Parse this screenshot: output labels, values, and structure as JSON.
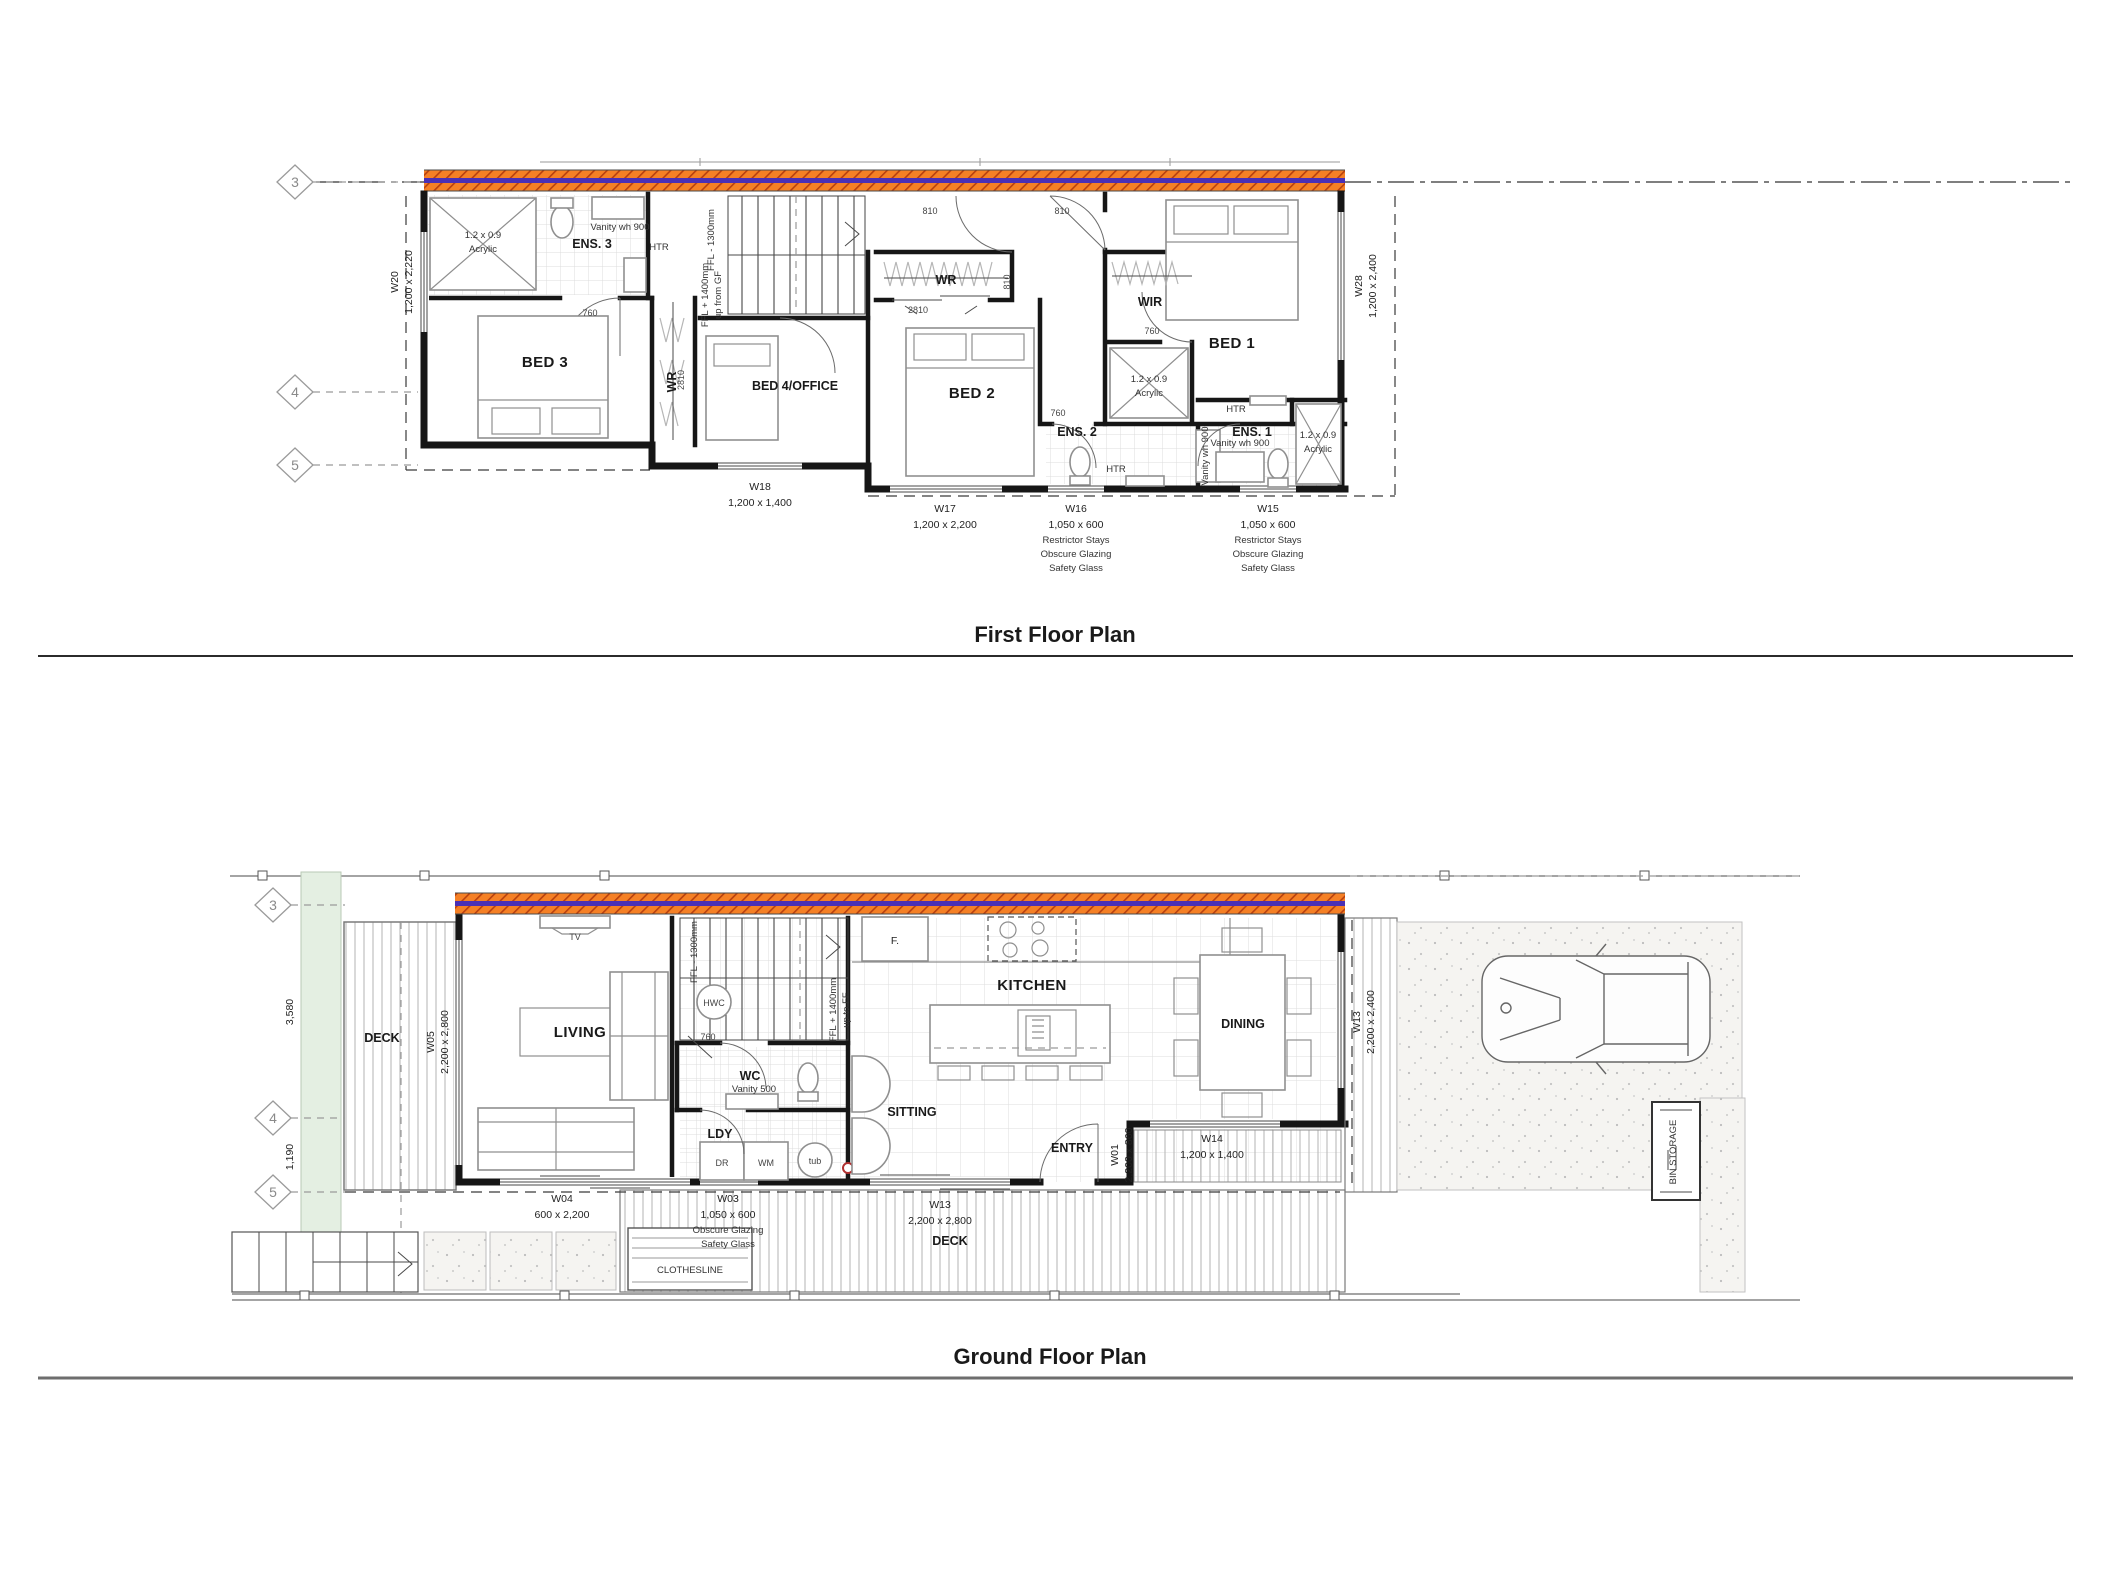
{
  "page": {
    "ff_title": "First Floor Plan",
    "gf_title": "Ground Floor Plan"
  },
  "colors": {
    "party_wall": "#f58025",
    "party_stripe": "#4a30b5"
  },
  "ff": {
    "rooms": {
      "ens3": "ENS. 3",
      "bed3": "BED 3",
      "bed4": "BED 4/OFFICE",
      "bed2": "BED 2",
      "bed1": "BED 1",
      "wir": "WIR",
      "wr": "WR",
      "ens2": "ENS. 2",
      "ens1": "ENS. 1"
    },
    "fix": {
      "shower_size": "1.2 x 0.9",
      "shower_mat": "Acrylic",
      "vanity": "Vanity wh 900",
      "htr": "HTR"
    },
    "stair": {
      "down": "FFL - 1300mm",
      "up1": "FFL + 1400mm",
      "up2": "up from GF"
    },
    "door": {
      "d760": "760",
      "d810": "810",
      "d2810": "2810"
    },
    "win": {
      "w20": [
        "W20",
        "1,200 x 2,220"
      ],
      "w28": [
        "W28",
        "1,200 x 2,400"
      ],
      "w18": [
        "W18",
        "1,200 x 1,400"
      ],
      "w17": [
        "W17",
        "1,200 x 2,200"
      ],
      "w16": [
        "W16",
        "1,050 x 600"
      ],
      "w15": [
        "W15",
        "1,050 x 600"
      ],
      "notes": [
        "Restrictor Stays",
        "Obscure Glazing",
        "Safety Glass"
      ]
    },
    "grid": [
      "3",
      "4",
      "5"
    ]
  },
  "gf": {
    "rooms": {
      "deck": "DECK",
      "living": "LIVING",
      "wc": "WC",
      "ldy": "LDY",
      "sitting": "SITTING",
      "kitchen": "KITCHEN",
      "dining": "DINING",
      "entry": "ENTRY",
      "clothesline": "CLOTHESLINE",
      "bin": "BIN STORAGE"
    },
    "fix": {
      "tv": "TV",
      "fridge": "F.",
      "dr": "DR",
      "wm": "WM",
      "tub": "tub",
      "vanity": "Vanity 500",
      "hwc": "HWC"
    },
    "stair": {
      "down": "FFL - 1300mm",
      "up1": "FFL + 1400mm",
      "up2": "up to FF"
    },
    "door": {
      "d760": "760"
    },
    "dim": {
      "a": "3,580",
      "b": "1,190"
    },
    "win": {
      "w05": [
        "W05",
        "2,200 x 2,800"
      ],
      "w04": [
        "W04",
        "600 x 2,200"
      ],
      "w03": [
        "W03",
        "1,050 x 600"
      ],
      "w03n": [
        "Obscure Glazing",
        "Safety Glass"
      ],
      "w13s": [
        "W13",
        "2,200 x 2,800"
      ],
      "w13e": [
        "W13",
        "2,200 x 2,400"
      ],
      "w14": [
        "W14",
        "1,200 x 1,400"
      ],
      "w01": [
        "W01",
        "2,200 x 860"
      ]
    },
    "grid": [
      "3",
      "4",
      "5"
    ]
  }
}
